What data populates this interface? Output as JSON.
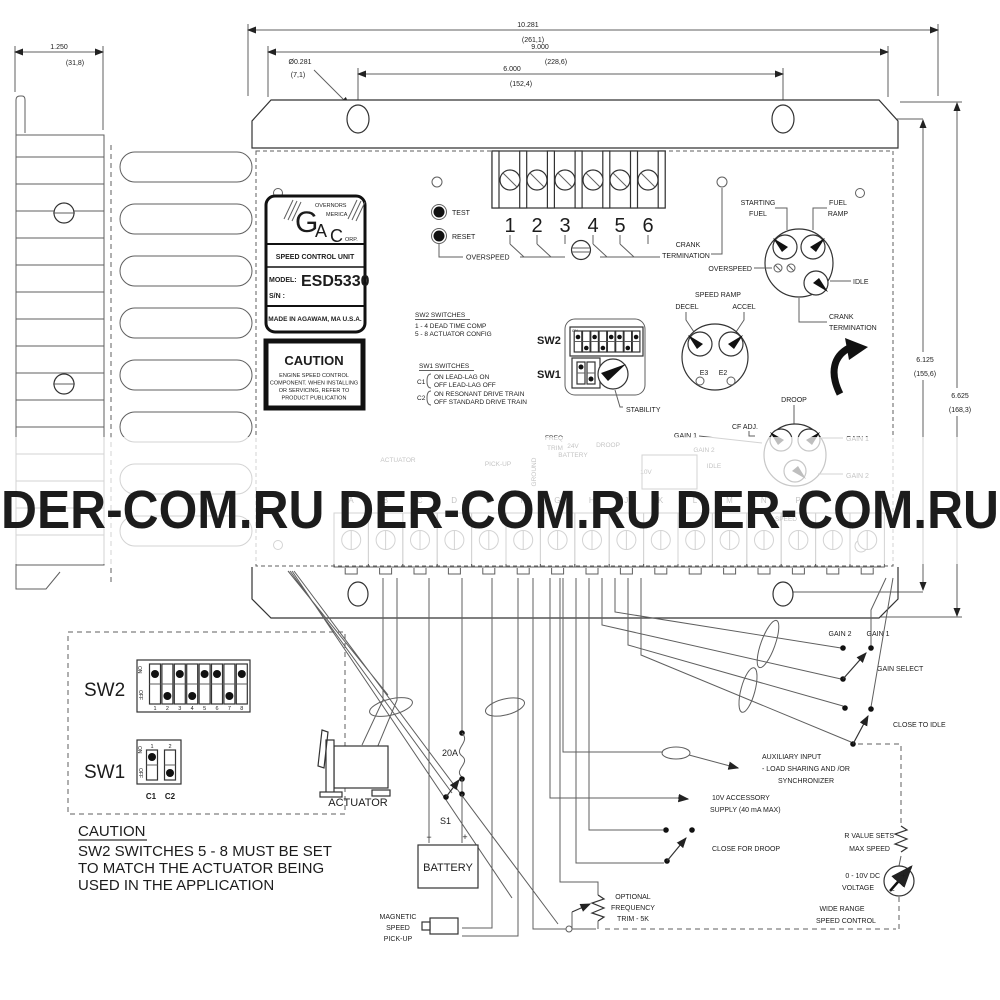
{
  "watermark": {
    "text": "DER-COM.RU DER-COM.RU DER-COM.RU",
    "color": "#7b8189"
  },
  "dimensions": {
    "overall_width": {
      "in": "10.281",
      "mm": "(261,1)"
    },
    "flange_width": {
      "in": "9.000",
      "mm": "(228,6)"
    },
    "hole_spacing": {
      "in": "6.000",
      "mm": "(152,4)"
    },
    "hole_diameter": {
      "in": "Ø0.281",
      "mm": "(7,1)"
    },
    "depth": {
      "in": "1.250",
      "mm": "(31,8)"
    },
    "height_holes": {
      "in": "6.125",
      "mm": "(155,6)"
    },
    "height_overall": {
      "in": "6.625",
      "mm": "(168,3)"
    }
  },
  "nameplate": {
    "letter_g": "G",
    "governors": "OVERNORS",
    "letter_a": "A",
    "america": "MERICA",
    "letter_c": "C",
    "corp": "ORP.",
    "unit": "SPEED CONTROL UNIT",
    "model_label": "MODEL:",
    "model": "ESD5330",
    "serial_label": "S/N :",
    "origin": "MADE IN AGAWAM, MA  U.S.A."
  },
  "caution_label": {
    "title": "CAUTION",
    "line1": "ENGINE SPEED CONTROL",
    "line2": "COMPONENT. WHEN INSTALLING",
    "line3": "OR SERVICING, REFER TO",
    "line4": "PRODUCT PUBLICATION"
  },
  "board": {
    "test": "TEST",
    "reset": "RESET",
    "overspeed": "OVERSPEED",
    "terminals": [
      "1",
      "2",
      "3",
      "4",
      "5",
      "6"
    ],
    "crank_top_line1": "CRANK",
    "crank_top_line2": "TERMINATION",
    "knobs": {
      "starting_line1": "STARTING",
      "starting_line2": "FUEL",
      "ramp_line1": "FUEL",
      "ramp_line2": "RAMP",
      "overspeed": "OVERSPEED",
      "idle": "IDLE",
      "crank_line1": "CRANK",
      "crank_line2": "TERMINATION"
    },
    "speed_ramp": {
      "title": "SPEED RAMP",
      "decel": "DECEL",
      "accel": "ACCEL",
      "e3": "E3",
      "e2": "E2"
    },
    "stability": "STABILITY",
    "droop": {
      "title": "DROOP",
      "cf_adj": "CF ADJ.",
      "gain1_left": "GAIN 1",
      "gain1_right": "GAIN 1",
      "gain2_right": "GAIN 2"
    },
    "sw2": "SW2",
    "sw1": "SW1",
    "dip_on": "ON",
    "notes": {
      "sw2_title": "SW2 SWITCHES",
      "sw2_line1": "1 - 4   DEAD TIME COMP",
      "sw2_line2": "5 - 8   ACTUATOR CONFIG",
      "sw1_title": "SW1 SWITCHES",
      "c1": "C1",
      "c1_on": "ON   LEAD-LAG ON",
      "c1_off": "OFF  LEAD-LAG OFF",
      "c2": "C2",
      "c2_on": "ON   RESONANT DRIVE TRAIN",
      "c2_off": "OFF  STANDARD DRIVE TRAIN"
    }
  },
  "dip_detail": {
    "sw2": "SW2",
    "sw1": "SW1",
    "on_top": "ON",
    "off_bottom": "OFF",
    "numbers": [
      "1",
      "2",
      "3",
      "4",
      "5",
      "6",
      "7",
      "8"
    ],
    "sw1_numbers": [
      "1",
      "2"
    ],
    "c1": "C1",
    "c2": "C2",
    "sw2_pattern": [
      1,
      0,
      1,
      0,
      1,
      1,
      0,
      1
    ],
    "sw1_pattern": [
      1,
      0
    ]
  },
  "caution_note": {
    "title": "CAUTION",
    "line1": "SW2 SWITCHES 5 - 8 MUST BE SET",
    "line2": "TO MATCH THE ACTUATOR BEING",
    "line3": "USED IN THE APPLICATION"
  },
  "circuit": {
    "actuator": "ACTUATOR",
    "fuse": "20A",
    "s1": "S1",
    "battery": "BATTERY",
    "minus": "−",
    "plus": "+",
    "pickup_line1": "MAGNETIC",
    "pickup_line2": "SPEED",
    "pickup_line3": "PICK-UP",
    "trim_line1": "OPTIONAL",
    "trim_line2": "FREQUENCY",
    "trim_line3": "TRIM - 5K",
    "gain2": "GAIN 2",
    "gain1": "GAIN 1",
    "gain_select": "GAIN SELECT",
    "close_to_idle": "CLOSE TO IDLE",
    "aux_line1": "AUXILIARY INPUT",
    "aux_line2": "-  LOAD SHARING AND /OR",
    "aux_line3": "SYNCHRONIZER",
    "supply_line1": "10V ACCESSORY",
    "supply_line2": "SUPPLY (40 mA MAX)",
    "close_for_droop": "CLOSE FOR DROOP",
    "rvalue_line1": "R VALUE SETS",
    "rvalue_line2": "MAX SPEED",
    "volt_line1": "0 - 10V DC",
    "volt_line2": "VOLTAGE",
    "wide_line1": "WIDE RANGE",
    "wide_line2": "SPEED CONTROL"
  },
  "faded": {
    "v24": "24V",
    "battery": "BATTERY",
    "actuator": "ACTUATOR",
    "pickup": "PICK-UP",
    "ground": "GROUND",
    "freq": "FREQ",
    "trim": "TRIM",
    "droop": "DROOP",
    "v10": "10V",
    "gain2": "GAIN 2",
    "idle": "IDLE",
    "speed": "SPEED",
    "letters": [
      "A",
      "B",
      "C",
      "D",
      "E",
      "F",
      "G",
      "H",
      "J",
      "K",
      "L",
      "M",
      "N",
      "P"
    ]
  }
}
